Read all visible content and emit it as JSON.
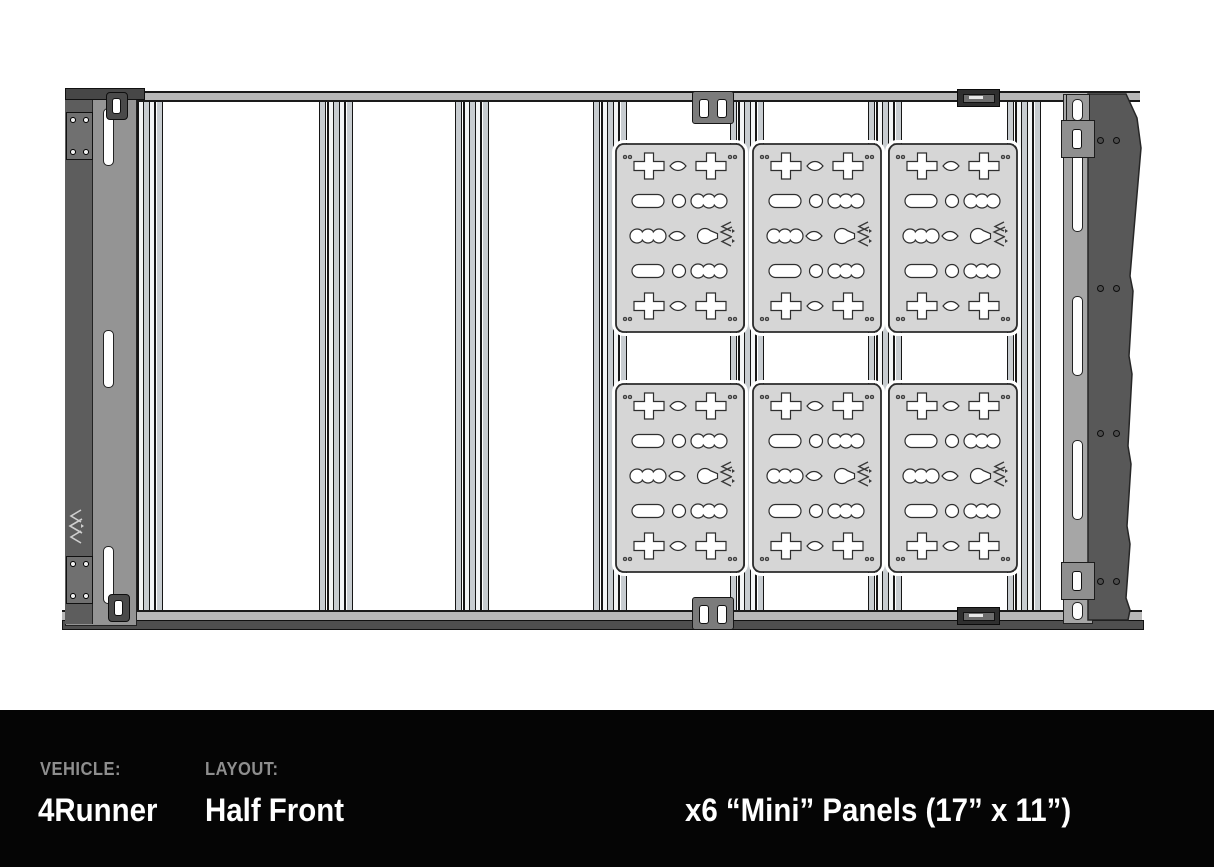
{
  "footer": {
    "vehicle_label": "VEHICLE:",
    "vehicle_value": "4Runner",
    "layout_label": "LAYOUT:",
    "layout_value": "Half Front",
    "panels_summary": "x6 “Mini” Panels (17” x 11”)"
  },
  "diagram": {
    "panel_count": 6,
    "panel_grid": {
      "rows": 2,
      "cols": 3
    },
    "crossbar_count": 7,
    "icons": {
      "panel_logo": "triple-chevron-mountain-brand-mark",
      "rail_logo": "triple-chevron-mountain-brand-mark"
    },
    "colors": {
      "panel_fill": "#d6d6d6",
      "slot_fill": "#ffffff",
      "outline": "#1c1c1c",
      "rail_dark": "#5d5d5d",
      "rail_mid": "#949494",
      "deflector": "#585858",
      "extrusion_light": "#c7ccd0",
      "footer_bg": "#050505",
      "footer_label": "#8e8e8e",
      "footer_value": "#ffffff"
    }
  }
}
